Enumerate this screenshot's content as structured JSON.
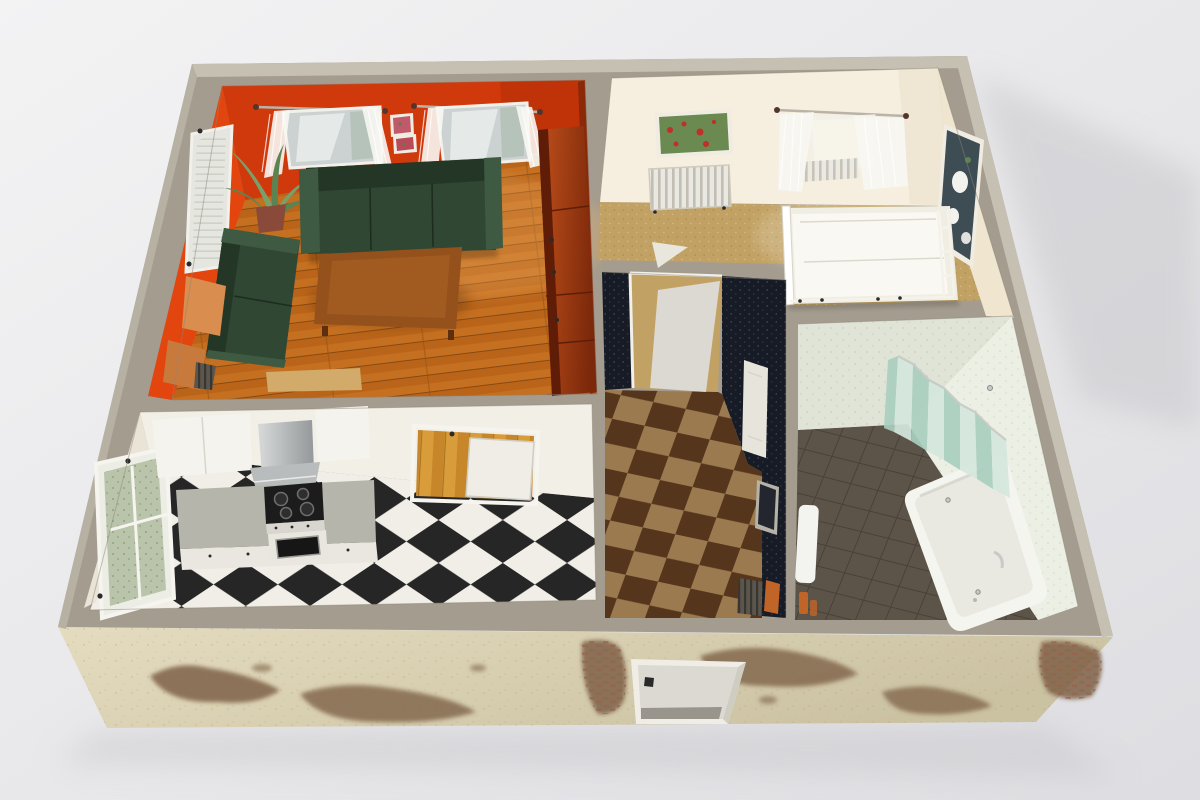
{
  "scene": {
    "type": "3d-apartment-floorplan-render",
    "rooms": [
      {
        "name": "living-room"
      },
      {
        "name": "bedroom"
      },
      {
        "name": "hallway"
      },
      {
        "name": "kitchen"
      },
      {
        "name": "bathroom"
      }
    ]
  },
  "colors": {
    "bg_top": "#f3f3f4",
    "bg_bottom": "#dedee2",
    "shadow": "#c9c9cd",
    "wall_top": "#a49c8e",
    "wall_top_light": "#c6c0b2",
    "wall_top_edge": "#b7b1a3",
    "facade_light": "#e5dcc0",
    "facade_dark": "#cbc2a2",
    "patch": "#7e6248",
    "brick": "#96644a",
    "door_frame": "#efede6",
    "door_panel": "#dcd9d2",
    "door_floor": "#9a958c",
    "door_shade": "#cfccc2",
    "handle": "#2a2a2a",
    "lr_wall": "#cf390c",
    "lr_wall_bright": "#e2450e",
    "lr_wall_shade": "#8a2807",
    "lr_wall_dark": "#b52f08",
    "wood": "#c56f20",
    "wood_dark": "#b76218",
    "wood_gap": "#7e4410",
    "wood_joint": "#8a4c12",
    "wood_light": "#f2b36a",
    "cab_light": "#c1501b",
    "cab_dark": "#7c290b",
    "cab_edge": "#5f1d08",
    "sofa": "#2f4733",
    "sofa_dark": "#243726",
    "sofa_light": "#3e5a42",
    "table": "#94511c",
    "table_light": "#ab6527",
    "leg": "#5e2f0e",
    "side_table": "#d98d4e",
    "side_table_dark": "#c87a3c",
    "desk": "#d2aa6a",
    "leaf": "#7aa06a",
    "leaf_dark": "#5c8452",
    "pot": "#8a4a3a",
    "glass": "#cbd2d1",
    "glass_reflect": "#9fb4a4",
    "rod": "#b9b3a8",
    "finial": "#52362c",
    "curtain": "#f8f7f3",
    "pic_frame": "#f0ece2",
    "pic_red": "#c05a6a",
    "pic_red2": "#b84a5a",
    "pic_green": "#5e7c4e",
    "br_wall": "#f6efdf",
    "br_wall_side": "#f0e6d0",
    "br_wall_shade": "#eee4cf",
    "carpet": "#c2a264",
    "carpet_dot": "#a9894e",
    "carpet_dot2": "#d8c08a",
    "poppy_bg": "#6a8a52",
    "poppy_red": "#c03028",
    "paint_dark": "#3e4c54",
    "flower_white": "#f2f2ee",
    "bed": "#f0ede2",
    "bed_white": "#faf8f2",
    "radiator": "#eae8e2",
    "radiator_shade": "#c2beb2",
    "radiator_dark": "#5a564e",
    "radiator_dark2": "#39362f",
    "hall_wall": "#171b26",
    "hall_dot": "#59617a",
    "hall_floor_light": "#9b7a50",
    "hall_floor_dark": "#55361c",
    "mirror": "#23262e",
    "mirror_frame": "#b5b2a8",
    "accent_orange": "#c06428",
    "k_wall": "#f2efe6",
    "k_wall_side": "#e9e4d6",
    "k_floor_light": "#f0eee6",
    "k_floor_dark": "#262626",
    "cabinet": "#f4f3ee",
    "counter": "#b5b5ab",
    "counter_edge": "#a2a298",
    "fronts": "#e9e7df",
    "steel_light": "#d8dada",
    "steel_dark": "#94989a",
    "cooktop": "#1c1c1c",
    "burner": "#2e2e2e",
    "oven": "#e8e6de",
    "oven_glass": "#161616",
    "entry_wood": "#d89c3a",
    "entry_wood_dark": "#c8862a",
    "entry_gap": "#9a6a1c",
    "garden": "#b9c4ab",
    "garden_dot": "#8fa37e",
    "blind": "#e5e6e0",
    "blind_line": "#c2c4ba",
    "bath_wall": "#e0e4d7",
    "bath_wall_dot": "#c9cfbc",
    "bath_wall2": "#ecefe4",
    "bath_wall2_dot": "#d7dcca",
    "bath_floor": "#5d5449",
    "bath_line": "#494137",
    "tub": "#f5f5f0",
    "tub_inner": "#e9e9e2",
    "tub_shade": "#cfcfc6",
    "screen_light": "#d5e8de",
    "screen_dark": "#a9cfc0",
    "chrome": "#c9c9c9",
    "white_fix": "#f3f3ef"
  }
}
